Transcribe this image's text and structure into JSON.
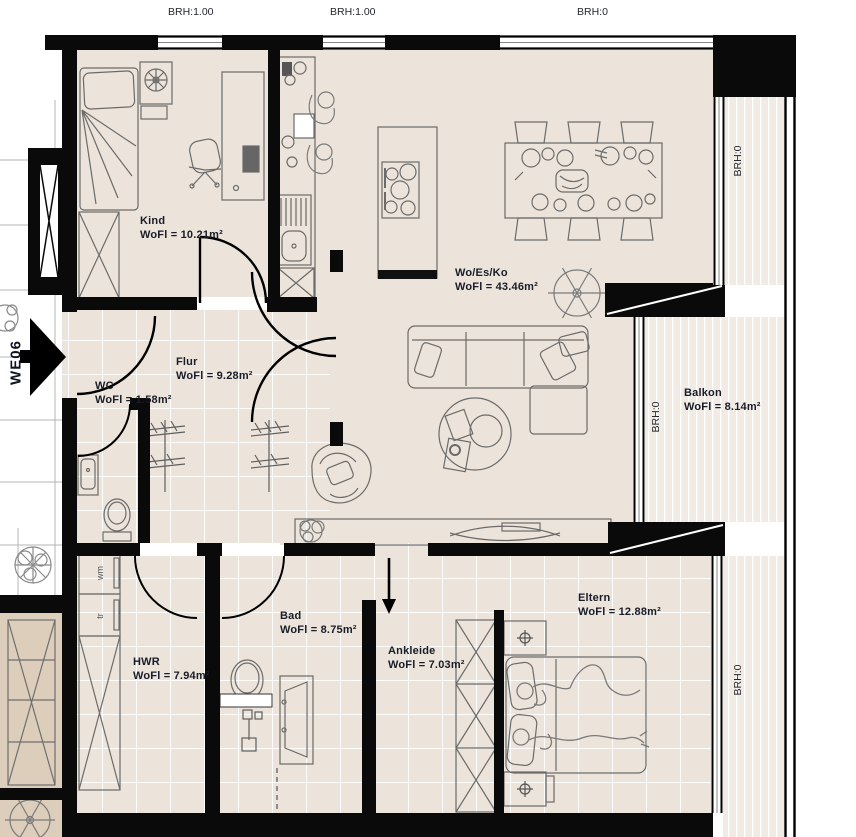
{
  "plan": {
    "unit_label": "WE06",
    "window_labels": {
      "top": [
        "BRH:1.00",
        "BRH:1.00",
        "BRH:0"
      ],
      "right_top": "BRH:0",
      "right_middle": "BRH:0",
      "right_bottom": "BRH:0"
    },
    "rooms": {
      "kind": {
        "name": "Kind",
        "area": "WoFl = 10.21m²"
      },
      "wo_es_ko": {
        "name": "Wo/Es/Ko",
        "area": "WoFl = 43.46m²"
      },
      "flur": {
        "name": "Flur",
        "area": "WoFl = 9.28m²"
      },
      "wc": {
        "name": "WC",
        "area": "WoFl = 1.58m²"
      },
      "balkon": {
        "name": "Balkon",
        "area": "WoFl = 8.14m²"
      },
      "hwr": {
        "name": "HWR",
        "area": "WoFl = 7.94m²"
      },
      "bad": {
        "name": "Bad",
        "area": "WoFl = 8.75m²"
      },
      "ankleide": {
        "name": "Ankleide",
        "area": "WoFl = 7.03m²"
      },
      "eltern": {
        "name": "Eltern",
        "area": "WoFl = 12.88m²"
      }
    },
    "appliances": {
      "washing_machine": "wm",
      "dryer": "tr"
    },
    "colors": {
      "wall": "#0a0a0a",
      "floor": "#ece4da",
      "balcony_floor": "#f1ebe3",
      "neighbor_floor": "#dccebb",
      "furniture_line": "#6b6b6b",
      "label_text": "#181d29"
    }
  }
}
